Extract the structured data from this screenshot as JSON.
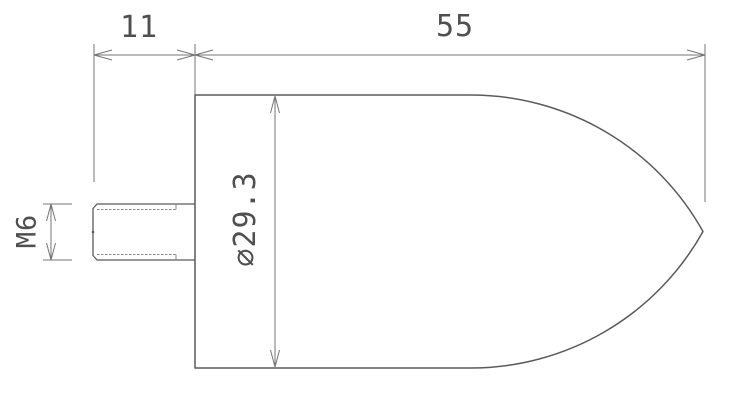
{
  "drawing": {
    "kind": "technical-drawing",
    "part": "ogive-nose-plunger-with-threaded-stud",
    "labels": {
      "stud_length": "11",
      "body_length": "55",
      "thread_spec": "M6",
      "diameter": "⌀29.3"
    },
    "colors": {
      "background": "#ffffff",
      "outline": "#5a5a5a",
      "dimension_line": "#757575",
      "thread_line": "#8a8a8a",
      "text": "#4f4f4f"
    }
  }
}
